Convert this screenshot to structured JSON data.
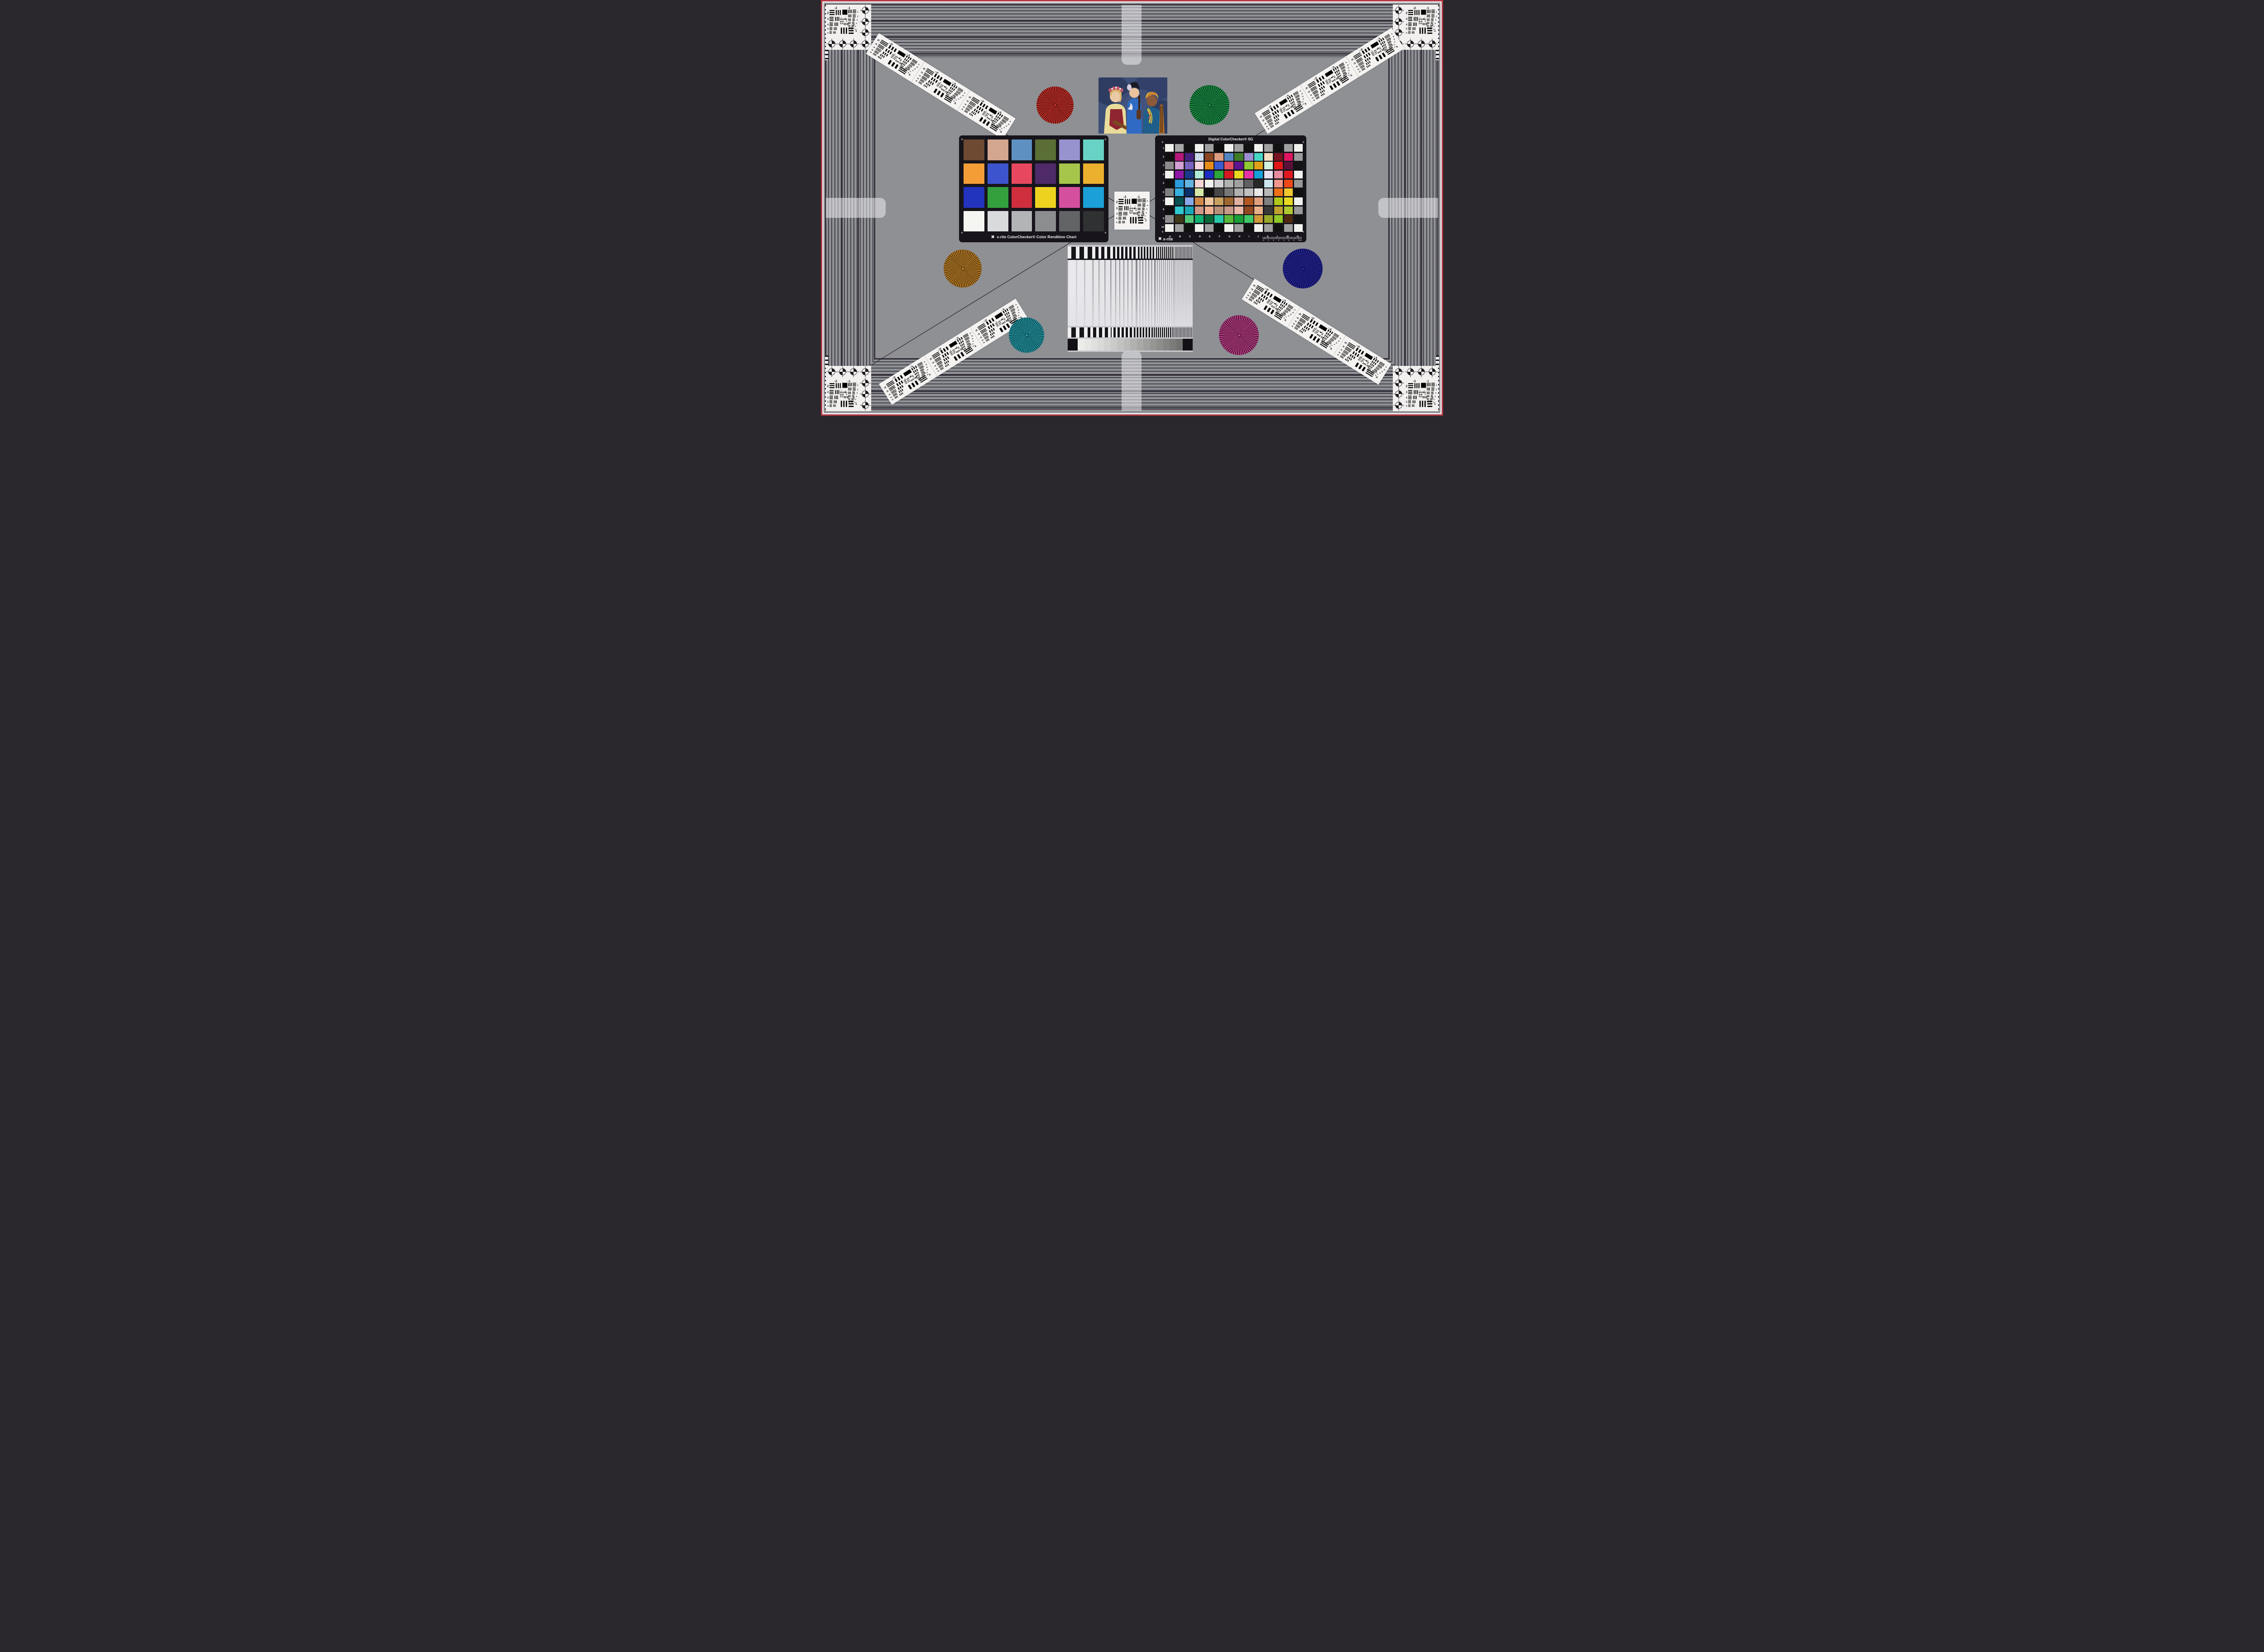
{
  "frame": {
    "border_red": "#b53a45",
    "border_white": "#ece9ec",
    "background": "#8e9094",
    "line": "#2b2733"
  },
  "colorchecker": {
    "caption": "x-rite ColorChecker® Color Rendition Chart",
    "logo": "✖",
    "patches": [
      [
        "#6e4a33",
        "#d3a68f",
        "#5e90c1",
        "#5a6e35",
        "#9793cf",
        "#67d2c5"
      ],
      [
        "#f49d37",
        "#3c55ce",
        "#e8485f",
        "#4e2a69",
        "#a5c64b",
        "#ebb02e"
      ],
      [
        "#2233bd",
        "#33a03d",
        "#cf2e3d",
        "#edd320",
        "#d4509f",
        "#1ba0d8"
      ],
      [
        "#f5f5f2",
        "#d9dadb",
        "#b2b4b5",
        "#8b8d8e",
        "#626465",
        "#2f3132"
      ]
    ]
  },
  "sg": {
    "title": "Digital ColorChecker® SG",
    "brand": "x-rite",
    "logo": "✖",
    "columns": [
      "A",
      "B",
      "C",
      "D",
      "E",
      "F",
      "G",
      "H",
      "I",
      "J",
      "K",
      "L",
      "M",
      "N"
    ],
    "rows": [
      "1",
      "2",
      "3",
      "4",
      "5",
      "6",
      "7",
      "8",
      "9",
      "10"
    ],
    "ruler": {
      "ticks": [
        "0",
        "1",
        "2",
        "3",
        "4",
        "5",
        "6"
      ],
      "unit": "mm"
    },
    "patches": [
      [
        "#f2f2ef",
        "#a8a8a8",
        "#111111",
        "#f2f2ef",
        "#a0a0a0",
        "#0e0e0e",
        "#f2f2ef",
        "#a0a0a0",
        "#111111",
        "#f2f2ef",
        "#a0a0a0",
        "#111111",
        "#a0a0a0",
        "#f2f2ef"
      ],
      [
        "#0f0f0f",
        "#b5187a",
        "#47207e",
        "#ccd9ea",
        "#8a4522",
        "#dd9c80",
        "#5585c2",
        "#3f7c28",
        "#9b8fd0",
        "#45d5c5",
        "#f7dcc0",
        "#7a1220",
        "#e01560",
        "#9a9a9a"
      ],
      [
        "#8c8c8c",
        "#d3a0d4",
        "#7a62c0",
        "#f4d6dc",
        "#e88d18",
        "#3a5cd0",
        "#e55060",
        "#5c1490",
        "#8ec832",
        "#e0a018",
        "#d2f2e0",
        "#e01818",
        "#5c1038",
        "#141414"
      ],
      [
        "#f2f2ef",
        "#8f18a8",
        "#1a3a8c",
        "#b2ead8",
        "#1b2ec2",
        "#2aa53c",
        "#d81a22",
        "#e8d820",
        "#e832a8",
        "#18a0d8",
        "#e8e0f0",
        "#e88aa0",
        "#e01820",
        "#f2f2ef"
      ],
      [
        "#0f0f0f",
        "#2b9ce0",
        "#62b5e0",
        "#f4d4d4",
        "#f2f2ef",
        "#d2d2d2",
        "#b0b2b0",
        "#a0a0a0",
        "#606060",
        "#282828",
        "#cfe8f0",
        "#f0988c",
        "#f04818",
        "#989898"
      ],
      [
        "#808080",
        "#38b0e0",
        "#0a3068",
        "#d8e8a8",
        "#101010",
        "#484848",
        "#787878",
        "#b0b0b0",
        "#c0c0c0",
        "#e8e8e8",
        "#b8b8b8",
        "#f07018",
        "#f0c830",
        "#101010"
      ],
      [
        "#f2f2ef",
        "#085050",
        "#88a8e8",
        "#d08848",
        "#f0c8a0",
        "#c8a060",
        "#a06830",
        "#e0b0a0",
        "#b05820",
        "#e0a080",
        "#808080",
        "#b0c818",
        "#e8d820",
        "#f2f2ef"
      ],
      [
        "#0f0f0f",
        "#30c8d0",
        "#18a8b8",
        "#d09888",
        "#f0b090",
        "#b89078",
        "#c89888",
        "#e8b8a8",
        "#904820",
        "#e8b088",
        "#383838",
        "#c0a030",
        "#b0c830",
        "#989898"
      ],
      [
        "#8c8c8c",
        "#403818",
        "#50c878",
        "#10b070",
        "#086838",
        "#28c8a8",
        "#58b838",
        "#18a038",
        "#40c868",
        "#d09838",
        "#98a828",
        "#90c828",
        "#502810",
        "#141414"
      ],
      [
        "#f2f2ef",
        "#a0a0a0",
        "#111111",
        "#f2f2ef",
        "#a0a0a0",
        "#0e0e0e",
        "#f2f2ef",
        "#a0a0a0",
        "#111111",
        "#f2f2ef",
        "#a0a0a0",
        "#111111",
        "#a0a0a0",
        "#f2f2ef"
      ]
    ]
  },
  "usaf": {
    "top_left": "-2",
    "top_right": "-1",
    "left": [
      "2",
      "3",
      "4",
      "5",
      "6"
    ],
    "right": [
      "1",
      "2",
      "3",
      "4",
      "5",
      "6"
    ],
    "bottom_label": "-2",
    "bottom_right": "1",
    "inner_left": "0",
    "inner_right": "1"
  },
  "stars": {
    "red": {
      "bright": "#d8392e",
      "dark": "#4a0c0c"
    },
    "green": {
      "bright": "#1f9a4b",
      "dark": "#063a1a"
    },
    "orange": {
      "bright": "#c8862e",
      "dark": "#4a3208"
    },
    "navy": {
      "bright": "#2a2aa8",
      "dark": "#0a0a3c"
    },
    "teal": {
      "bright": "#2aa4b0",
      "dark": "#083c44"
    },
    "magenta": {
      "bright": "#c2488e",
      "dark": "#4a0e34"
    }
  },
  "ramp": {
    "steps": [
      [
        "#ececea",
        "#e6e6e4",
        "#e0e0de",
        "#d9d9d7",
        "#d2d2d0",
        "#cacac8",
        "#c2c2c0",
        "#babab8",
        "#b1b1af",
        "#a8a8a6",
        "#9f9f9d",
        "#969694",
        "#8d8d8b",
        "#848482",
        "#7b7b79",
        "#727270"
      ]
    ]
  }
}
